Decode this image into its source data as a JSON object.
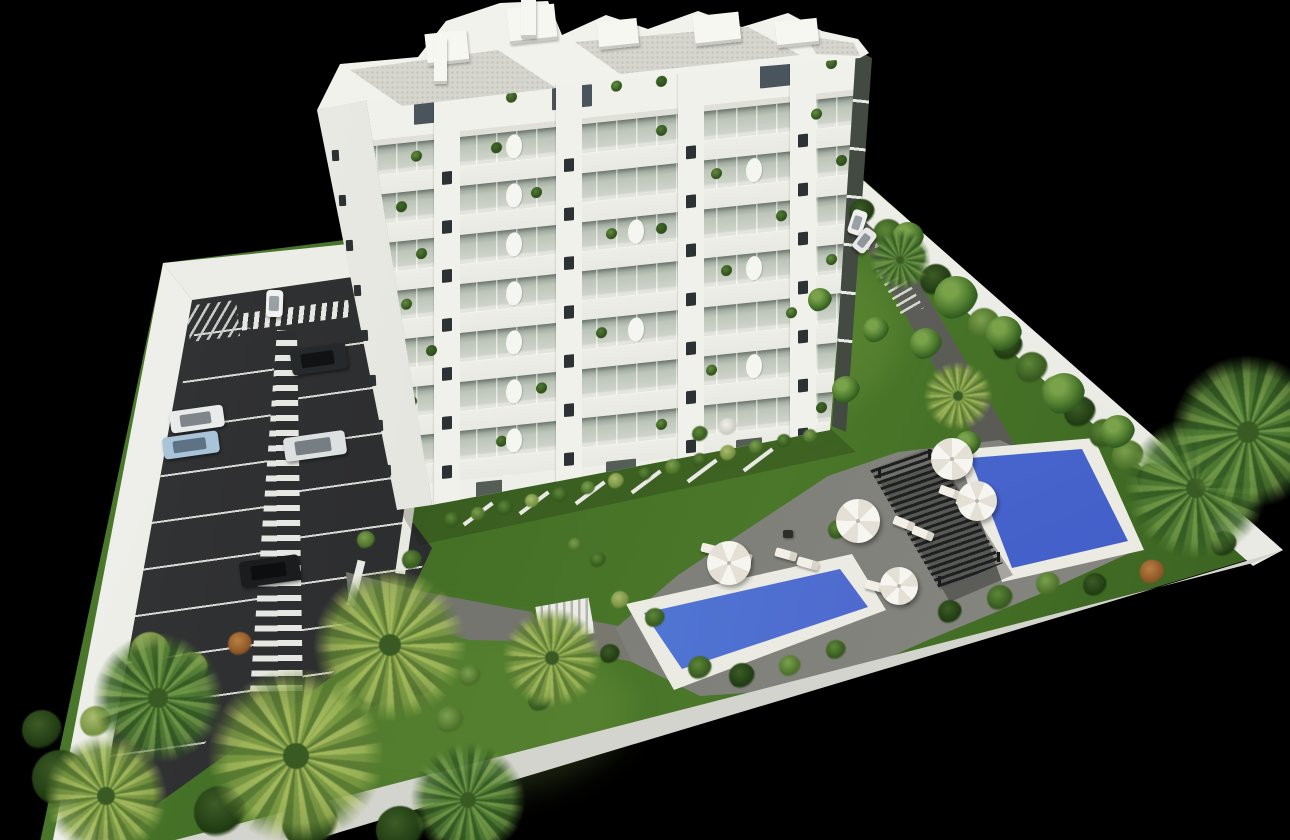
{
  "image": {
    "type": "3d-architectural-rendering",
    "subject": "aerial isometric view of a white multi-storey apartment building with parking lot, landscaped garden, pergola and two swimming pools",
    "background_color": "#000000"
  },
  "palette": {
    "grass": "#44702a",
    "asphalt": "#2e2f31",
    "line_white": "#d8d8d5",
    "deck": "#8a8a84",
    "path": "#75756f",
    "wall": "#ececE6",
    "building_white": "#efefe9",
    "glass": "#c8cfc3",
    "window": "#2c3134",
    "roof_gravel": "#d6d6cf",
    "water_light": "#9ed0e9",
    "water_deep": "#3e57c4",
    "pergola": "#1d1f20",
    "lounger": "#f2efe6",
    "bush_colors": [
      [
        "#3d5c26",
        "#1f3a12"
      ],
      [
        "#5d8838",
        "#35571e"
      ],
      [
        "#7ba04f",
        "#4a7028"
      ],
      [
        "#b97f42",
        "#8a5526"
      ],
      [
        "#aabb6e",
        "#74903f"
      ],
      [
        "#f2f2ea",
        "#c9c9c0"
      ]
    ],
    "palm_gold": [
      "#a3b85c",
      "#7d9a44",
      "#5c7c34"
    ],
    "palm_green": [
      "#6f9646",
      "#4f7a33",
      "#355c24"
    ]
  },
  "building": {
    "floors": 8,
    "pier_columns": 4,
    "piers_x": [
      78,
      200,
      322,
      434
    ],
    "pier_width": 26,
    "band_top": 59,
    "band_height": 49,
    "west_window_count": 8,
    "penthouse_windows": [
      [
        58,
        10,
        46,
        22
      ],
      [
        196,
        10,
        40,
        22
      ],
      [
        404,
        8,
        46,
        24
      ]
    ],
    "ground_openings": [
      [
        120,
        455,
        26,
        16
      ],
      [
        250,
        448,
        30,
        16
      ],
      [
        380,
        440,
        26,
        16
      ]
    ],
    "balcony_plants": [
      [
        0,
        150
      ],
      [
        0,
        255
      ],
      [
        0,
        300
      ],
      [
        0,
        470
      ],
      [
        1,
        55
      ],
      [
        1,
        135
      ],
      [
        1,
        300
      ],
      [
        1,
        455
      ],
      [
        2,
        40
      ],
      [
        2,
        175
      ],
      [
        2,
        355
      ],
      [
        2,
        480
      ],
      [
        3,
        60
      ],
      [
        3,
        250
      ],
      [
        3,
        300
      ],
      [
        3,
        420
      ],
      [
        4,
        45
      ],
      [
        4,
        150
      ],
      [
        4,
        365
      ],
      [
        4,
        470
      ],
      [
        5,
        70
      ],
      [
        5,
        240
      ],
      [
        5,
        430
      ],
      [
        6,
        50
      ],
      [
        6,
        180
      ],
      [
        6,
        350
      ],
      [
        6,
        490
      ],
      [
        7,
        140
      ],
      [
        7,
        300
      ],
      [
        7,
        460
      ]
    ],
    "plant_colors": [
      "#4e7a32",
      "#628e3d",
      "#3f6828"
    ],
    "curved_dividers": [
      [
        1,
        150
      ],
      [
        2,
        150
      ],
      [
        3,
        150
      ],
      [
        4,
        150
      ],
      [
        5,
        150
      ],
      [
        6,
        150
      ],
      [
        7,
        150
      ],
      [
        2,
        390
      ],
      [
        4,
        390
      ],
      [
        6,
        390
      ],
      [
        3,
        272
      ],
      [
        5,
        272
      ]
    ],
    "rooftop_boxes": [
      [
        426,
        32,
        42,
        32
      ],
      [
        508,
        6,
        48,
        36
      ],
      [
        598,
        20,
        40,
        28
      ],
      [
        694,
        14,
        46,
        30
      ],
      [
        776,
        20,
        42,
        26
      ]
    ],
    "chimneys": [
      [
        434,
        38,
        13,
        46
      ],
      [
        521,
        0,
        15,
        38
      ]
    ],
    "terrace_walls": [
      [
        460,
        512
      ],
      [
        516,
        501
      ],
      [
        572,
        491
      ],
      [
        628,
        480
      ],
      [
        684,
        469
      ],
      [
        740,
        458
      ]
    ]
  },
  "parking": {
    "bay_rows_left": 9,
    "bay_rows_right": 8,
    "walkway_stripes": 24,
    "crosswalk_stripes": 10,
    "cars": [
      {
        "name": "suv-dark",
        "x": 319,
        "y": 359,
        "w": 56,
        "h": 26,
        "rot": -8,
        "body": "#26292b",
        "glass": "#101214"
      },
      {
        "name": "sedan-black",
        "x": 270,
        "y": 571,
        "w": 60,
        "h": 26,
        "rot": -8,
        "body": "#1a1c1e",
        "glass": "#0d0e10"
      },
      {
        "name": "hatchback-white",
        "x": 197,
        "y": 419,
        "w": 54,
        "h": 22,
        "rot": -8,
        "body": "#e9ebea",
        "glass": "#7e868c"
      },
      {
        "name": "sedan-lightblue",
        "x": 191,
        "y": 445,
        "w": 56,
        "h": 22,
        "rot": -8,
        "body": "#a9c4d9",
        "glass": "#5d7285"
      },
      {
        "name": "sedan-white",
        "x": 315,
        "y": 446,
        "w": 62,
        "h": 24,
        "rot": -8,
        "body": "#dde0e0",
        "glass": "#767e84"
      },
      {
        "name": "car-driving-white",
        "x": 274,
        "y": 303,
        "w": 17,
        "h": 27,
        "rot": 2,
        "body": "#f1f2ef",
        "glass": "#9aa1a6"
      },
      {
        "name": "car-entrance-a",
        "x": 857,
        "y": 222,
        "w": 15,
        "h": 25,
        "rot": 18,
        "body": "#eff0ed",
        "glass": "#9aa1a6"
      },
      {
        "name": "car-entrance-b",
        "x": 864,
        "y": 240,
        "w": 15,
        "h": 25,
        "rot": 38,
        "body": "#e8e9e6",
        "glass": "#8f969b"
      }
    ]
  },
  "pool_area": {
    "pools": 2,
    "umbrellas": [
      {
        "x": 952,
        "y": 459,
        "r": 21
      },
      {
        "x": 977,
        "y": 501,
        "r": 20
      },
      {
        "x": 858,
        "y": 521,
        "r": 22
      },
      {
        "x": 729,
        "y": 563,
        "r": 22
      },
      {
        "x": 899,
        "y": 586,
        "r": 19
      }
    ],
    "loungers": [
      [
        712,
        549,
        14
      ],
      [
        741,
        556,
        14
      ],
      [
        786,
        554,
        16
      ],
      [
        808,
        563,
        16
      ],
      [
        876,
        586,
        15
      ],
      [
        899,
        595,
        15
      ],
      [
        904,
        523,
        22
      ],
      [
        923,
        533,
        22
      ],
      [
        950,
        492,
        20
      ],
      [
        967,
        503,
        20
      ]
    ],
    "grill": [
      783,
      530,
      10,
      8
    ]
  },
  "vegetation": {
    "palms": [
      {
        "x": 390,
        "y": 645,
        "r": 80,
        "k": "gold"
      },
      {
        "x": 296,
        "y": 756,
        "r": 92,
        "k": "gold"
      },
      {
        "x": 158,
        "y": 698,
        "r": 68,
        "k": "green"
      },
      {
        "x": 106,
        "y": 796,
        "r": 64,
        "k": "gold"
      },
      {
        "x": 468,
        "y": 800,
        "r": 60,
        "k": "green"
      },
      {
        "x": 552,
        "y": 658,
        "r": 52,
        "k": "gold"
      },
      {
        "x": 958,
        "y": 396,
        "r": 36,
        "k": "gold"
      },
      {
        "x": 900,
        "y": 260,
        "r": 32,
        "k": "green"
      },
      {
        "x": 1196,
        "y": 488,
        "r": 74,
        "k": "green"
      },
      {
        "x": 1248,
        "y": 432,
        "r": 80,
        "k": "green"
      }
    ],
    "garden_trees": [
      {
        "x": 908,
        "y": 238,
        "r": 16
      },
      {
        "x": 956,
        "y": 298,
        "r": 22
      },
      {
        "x": 926,
        "y": 344,
        "r": 16
      },
      {
        "x": 1004,
        "y": 334,
        "r": 18
      },
      {
        "x": 1064,
        "y": 394,
        "r": 21
      },
      {
        "x": 1118,
        "y": 432,
        "r": 17
      },
      {
        "x": 968,
        "y": 444,
        "r": 13
      },
      {
        "x": 846,
        "y": 390,
        "r": 14
      },
      {
        "x": 820,
        "y": 300,
        "r": 12
      },
      {
        "x": 876,
        "y": 330,
        "r": 13
      }
    ],
    "hedge_right_wall": [
      [
        862,
        212,
        13,
        0
      ],
      [
        888,
        234,
        15,
        1
      ],
      [
        912,
        258,
        14,
        2
      ],
      [
        936,
        280,
        16,
        0
      ],
      [
        960,
        302,
        14,
        1
      ],
      [
        984,
        324,
        16,
        2
      ],
      [
        1008,
        346,
        15,
        0
      ],
      [
        1032,
        368,
        16,
        1
      ],
      [
        1056,
        390,
        14,
        2
      ],
      [
        1080,
        412,
        16,
        0
      ],
      [
        1104,
        434,
        15,
        1
      ],
      [
        1128,
        456,
        16,
        2
      ],
      [
        1152,
        478,
        15,
        0
      ],
      [
        1176,
        500,
        16,
        1
      ],
      [
        1200,
        522,
        14,
        2
      ],
      [
        1224,
        544,
        13,
        0
      ]
    ],
    "hedge_bottom_wall": [
      [
        372,
        692,
        16,
        1
      ],
      [
        420,
        684,
        13,
        0
      ],
      [
        470,
        676,
        11,
        2
      ],
      [
        560,
        666,
        12,
        1
      ],
      [
        610,
        654,
        10,
        0
      ],
      [
        700,
        668,
        12,
        1
      ],
      [
        742,
        676,
        13,
        0
      ],
      [
        790,
        666,
        11,
        2
      ],
      [
        836,
        650,
        10,
        1
      ],
      [
        950,
        612,
        12,
        0
      ],
      [
        1000,
        598,
        13,
        1
      ],
      [
        1048,
        584,
        12,
        2
      ],
      [
        1095,
        585,
        12,
        0
      ],
      [
        1152,
        572,
        12,
        3
      ]
    ],
    "building_base_hedges": [
      [
        452,
        520,
        8,
        1
      ],
      [
        478,
        514,
        7,
        2
      ],
      [
        505,
        508,
        8,
        1
      ],
      [
        532,
        501,
        7,
        4
      ],
      [
        560,
        495,
        8,
        1
      ],
      [
        588,
        488,
        7,
        2
      ],
      [
        616,
        481,
        8,
        4
      ],
      [
        645,
        474,
        7,
        1
      ],
      [
        673,
        467,
        8,
        2
      ],
      [
        700,
        460,
        7,
        1
      ],
      [
        728,
        453,
        8,
        4
      ],
      [
        756,
        447,
        7,
        2
      ],
      [
        784,
        441,
        7,
        1
      ],
      [
        810,
        436,
        7,
        2
      ]
    ],
    "misc_bushes": [
      [
        408,
        630,
        14,
        3
      ],
      [
        240,
        644,
        12,
        3
      ],
      [
        150,
        652,
        20,
        4
      ],
      [
        192,
        668,
        16,
        4
      ],
      [
        96,
        722,
        16,
        4
      ],
      [
        862,
        514,
        12,
        3
      ],
      [
        838,
        530,
        10,
        1
      ],
      [
        728,
        427,
        9,
        5
      ],
      [
        700,
        434,
        8,
        1
      ],
      [
        655,
        618,
        10,
        1
      ],
      [
        620,
        600,
        9,
        4
      ],
      [
        412,
        560,
        10,
        1
      ],
      [
        366,
        540,
        9,
        2
      ],
      [
        540,
        700,
        12,
        1
      ],
      [
        450,
        720,
        14,
        2
      ],
      [
        60,
        778,
        28,
        0
      ],
      [
        130,
        800,
        30,
        0
      ],
      [
        220,
        812,
        26,
        0
      ],
      [
        310,
        822,
        28,
        0
      ],
      [
        400,
        830,
        24,
        0
      ],
      [
        478,
        826,
        22,
        0
      ],
      [
        42,
        730,
        20,
        0
      ],
      [
        598,
        560,
        8,
        1
      ],
      [
        575,
        545,
        7,
        2
      ],
      [
        1152,
        572,
        12,
        3
      ]
    ]
  }
}
